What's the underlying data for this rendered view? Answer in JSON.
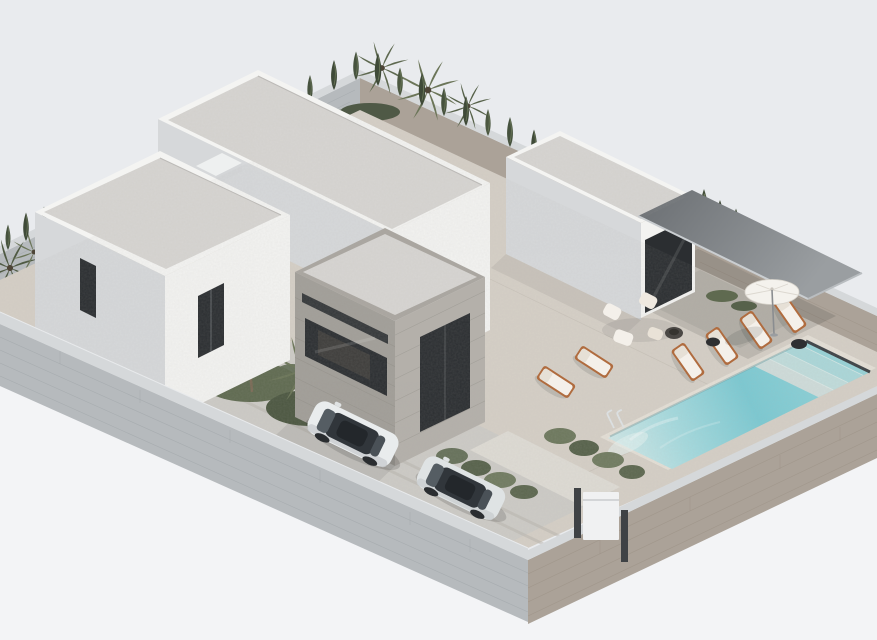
{
  "scene": {
    "kind": "photorealistic 3D architectural render",
    "subject": "Aerial isometric render of a modern single-storey villa: white flat-roofed volumes with gravel roofs, a stone-clad entrance volume, dark flat canopy over a pool terrace with sun loungers and a parasol, rectangular swimming pool with steps and ladder, stone perimeter wall with cypress and palm trees, and two white cars parked in the driveway",
    "view": "isometric aerial from the south-west",
    "background": "plain pale grey studio backdrop"
  },
  "palette": {
    "background": "#e9ebee",
    "background_lower": "#f3f4f6",
    "white_wall_lit": "#f3f3f1",
    "white_wall_shade": "#d6d8da",
    "roof_gravel": "#d7d5d2",
    "stone_cladding": "#a19e98",
    "stone_cladding_lit": "#b4b0aa",
    "terrace_paving": "#d5cfc6",
    "driveway": "#cdcbc6",
    "walkway": "#dedbd4",
    "wall_cap": "#d5d8da",
    "wall_face_cool": "#b6babd",
    "wall_face_warm": "#aba298",
    "canopy": "#82868a",
    "pool_coping": "#e4dfd6",
    "pool_shallow": "#cfe7e7",
    "pool_deep": "#7bc9d2",
    "pool_drain": "#3c4145",
    "glass_dark": "#2b2e31",
    "wood_frame": "#b06c3f",
    "cushion_white": "#f4f0ea",
    "foliage_dark": "#46523e",
    "foliage_light": "#6b7558",
    "car_body": "#e9eced",
    "gate_panel": "#f0f1f2"
  },
  "inventory": {
    "building_volumes": 4,
    "sun_loungers": 6,
    "parasols": 1,
    "cars": 2,
    "pool_steps": 4,
    "pool_ladders": 1,
    "fire_pits": 1,
    "gates": 1,
    "cypress_trees": 18,
    "palm_trees": 8
  }
}
